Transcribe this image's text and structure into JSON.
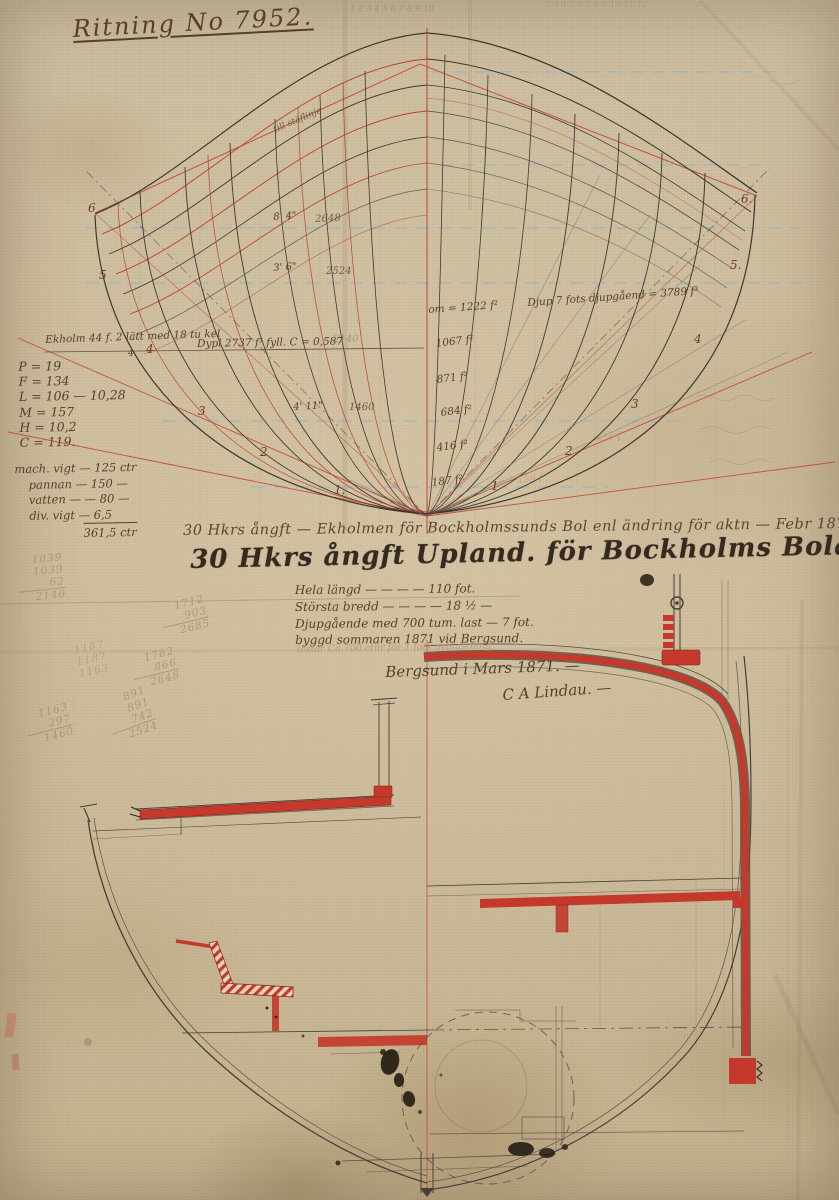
{
  "document": {
    "title": "Ritning No 7952."
  },
  "body_plan": {
    "scribble_top_1": "1 2 3 4 5 6 7 8 9 10",
    "scribble_top_2": "2 3 4 5 6 7 8 9 10 11 12",
    "stem_note": "till stäflinje",
    "waterlines": [
      {
        "dim": "8' 4\"",
        "sum": "2648"
      },
      {
        "dim": "3' 6\"",
        "sum": "2524"
      },
      {
        "dim": "4' 11\"",
        "sum": "1460"
      }
    ],
    "pencil_mid": "2140",
    "keel_note": "Ekholm 44 f. 2 lätt med 18 tu kel",
    "keel_note_sub": "4",
    "displacement_note": "Dypl 2737 f³  fyll. C = 0,587",
    "constants": [
      "P = 19",
      "F = 134",
      "L = 106 — 10,28",
      "M = 157",
      "H = 10,2",
      "C = 119."
    ],
    "weights": {
      "rows": [
        "mach. vigt — 125 ctr",
        "pannan — 150 —",
        "vatten —  — 80 —",
        "div. vigt — 6,5"
      ],
      "total": "361,5 ctr"
    },
    "areas": [
      "om = 1222 f²",
      "1067 f²",
      "871 f²",
      "684 f²",
      "416 f²",
      "187 f²"
    ],
    "displacement_right": "Djup 7 fots djupgåend = 3789 f³",
    "ghost_areas": [
      "416 f",
      "159 f"
    ],
    "sections_left": [
      "6",
      "5",
      "4",
      "3",
      "2",
      "1."
    ],
    "sections_right": [
      "6.",
      "5.",
      "4",
      "3",
      "2",
      "1"
    ]
  },
  "inscriptions": {
    "line1": "30 Hkrs ångft — Ekholmen för Bockholmssunds Bol enl ändring för aktn — Febr 1876 —",
    "line2": "30 Hkrs ångft Upland. för Bockholms Bolaget",
    "specs": [
      "Hela längd — — — — 110 fot.",
      "Största bredd — — — — 18 ½ —",
      "Djupgående med 700 tum. last — 7 fot.",
      "byggd sommaren 1871 vid Bergsund."
    ],
    "load_note": "lastar Ca 700 ctnr för 1 fots nedlastning",
    "place_date": "Bergsund i Mars 1871. —",
    "signature": "C A Lindau. —"
  },
  "pencil_sums": {
    "a": {
      "l1": "1039",
      "l2": "1039",
      "l3": "62",
      "total": "2140"
    },
    "b": {
      "l1": "1712",
      "l2": "903",
      "total": "2685"
    },
    "c": {
      "l1": "1782",
      "l2": "866",
      "total": "2648"
    },
    "d": {
      "l1": "891",
      "l2": "891",
      "l3": "742",
      "total": "2524"
    },
    "e": {
      "l1": "1187",
      "l2": "1187",
      "l3": "1163"
    },
    "f": {
      "l1": "1163",
      "l2": "297",
      "total": "1460"
    }
  },
  "colors": {
    "paper": "#cfc0a3",
    "ink": "#54402c",
    "red_ink": "#c4392b",
    "pencil": "#8d7f6d",
    "waterline_blue": "#8fb3c8"
  }
}
